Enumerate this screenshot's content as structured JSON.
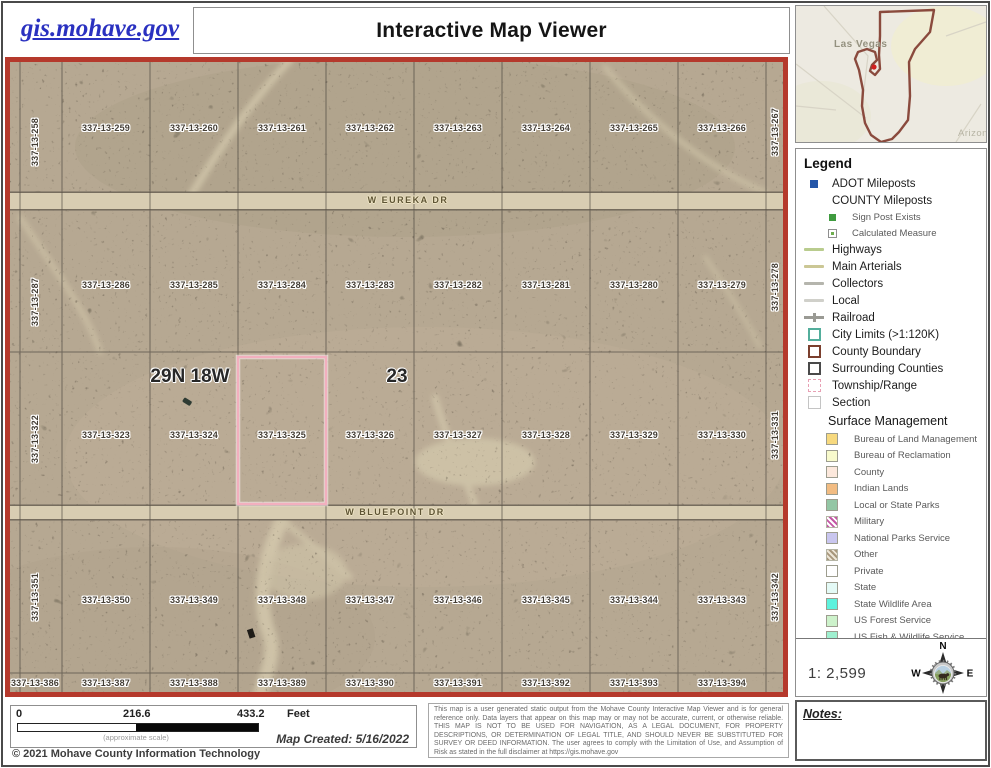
{
  "header": {
    "site_link": "gis.mohave.gov",
    "title": "Interactive Map Viewer"
  },
  "overview_map": {
    "city_label": "Las Vegas",
    "state_label": "Arizona",
    "boundary_color": "#8a4a3d",
    "marker_color": "#d11f1f"
  },
  "map": {
    "township_label": "29N 18W",
    "section_label": "23",
    "selected_parcel": "337-13-325",
    "selected_outline_color": "#f2afbe",
    "boundary_color": "#b5392c",
    "roads": [
      {
        "name": "W EUREKA DR",
        "x": 403,
        "y": 143
      },
      {
        "name": "W BLUEPOINT DR",
        "x": 390,
        "y": 455
      }
    ],
    "parcels": [
      {
        "label": "337-13-258",
        "x": 30,
        "y": 85,
        "vertical": true
      },
      {
        "label": "337-13-259",
        "x": 101,
        "y": 71
      },
      {
        "label": "337-13-260",
        "x": 189,
        "y": 71
      },
      {
        "label": "337-13-261",
        "x": 277,
        "y": 71
      },
      {
        "label": "337-13-262",
        "x": 365,
        "y": 71
      },
      {
        "label": "337-13-263",
        "x": 453,
        "y": 71
      },
      {
        "label": "337-13-264",
        "x": 541,
        "y": 71
      },
      {
        "label": "337-13-265",
        "x": 629,
        "y": 71
      },
      {
        "label": "337-13-266",
        "x": 717,
        "y": 71
      },
      {
        "label": "337-13-267",
        "x": 770,
        "y": 75,
        "vertical": true
      },
      {
        "label": "337-13-287",
        "x": 30,
        "y": 245,
        "vertical": true
      },
      {
        "label": "337-13-286",
        "x": 101,
        "y": 228
      },
      {
        "label": "337-13-285",
        "x": 189,
        "y": 228
      },
      {
        "label": "337-13-284",
        "x": 277,
        "y": 228
      },
      {
        "label": "337-13-283",
        "x": 365,
        "y": 228
      },
      {
        "label": "337-13-282",
        "x": 453,
        "y": 228
      },
      {
        "label": "337-13-281",
        "x": 541,
        "y": 228
      },
      {
        "label": "337-13-280",
        "x": 629,
        "y": 228
      },
      {
        "label": "337-13-279",
        "x": 717,
        "y": 228
      },
      {
        "label": "337-13-278",
        "x": 770,
        "y": 230,
        "vertical": true
      },
      {
        "label": "337-13-322",
        "x": 30,
        "y": 382,
        "vertical": true
      },
      {
        "label": "337-13-323",
        "x": 101,
        "y": 378
      },
      {
        "label": "337-13-324",
        "x": 189,
        "y": 378
      },
      {
        "label": "337-13-325",
        "x": 277,
        "y": 378
      },
      {
        "label": "337-13-326",
        "x": 365,
        "y": 378
      },
      {
        "label": "337-13-327",
        "x": 453,
        "y": 378
      },
      {
        "label": "337-13-328",
        "x": 541,
        "y": 378
      },
      {
        "label": "337-13-329",
        "x": 629,
        "y": 378
      },
      {
        "label": "337-13-330",
        "x": 717,
        "y": 378
      },
      {
        "label": "337-13-331",
        "x": 770,
        "y": 378,
        "vertical": true
      },
      {
        "label": "337-13-351",
        "x": 30,
        "y": 540,
        "vertical": true
      },
      {
        "label": "337-13-350",
        "x": 101,
        "y": 543
      },
      {
        "label": "337-13-349",
        "x": 189,
        "y": 543
      },
      {
        "label": "337-13-348",
        "x": 277,
        "y": 543
      },
      {
        "label": "337-13-347",
        "x": 365,
        "y": 543
      },
      {
        "label": "337-13-346",
        "x": 453,
        "y": 543
      },
      {
        "label": "337-13-345",
        "x": 541,
        "y": 543
      },
      {
        "label": "337-13-344",
        "x": 629,
        "y": 543
      },
      {
        "label": "337-13-343",
        "x": 717,
        "y": 543
      },
      {
        "label": "337-13-342",
        "x": 770,
        "y": 540,
        "vertical": true
      },
      {
        "label": "337-13-386",
        "x": 30,
        "y": 626
      },
      {
        "label": "337-13-387",
        "x": 101,
        "y": 626
      },
      {
        "label": "337-13-388",
        "x": 189,
        "y": 626
      },
      {
        "label": "337-13-389",
        "x": 277,
        "y": 626
      },
      {
        "label": "337-13-390",
        "x": 365,
        "y": 626
      },
      {
        "label": "337-13-391",
        "x": 453,
        "y": 626
      },
      {
        "label": "337-13-392",
        "x": 541,
        "y": 626
      },
      {
        "label": "337-13-393",
        "x": 629,
        "y": 626
      },
      {
        "label": "337-13-394",
        "x": 717,
        "y": 626
      }
    ]
  },
  "legend": {
    "title": "Legend",
    "items": [
      {
        "label": "ADOT Mileposts",
        "swatch": "square-fill",
        "color": "#2456a8",
        "size": 8,
        "icon": "adot-milepost-icon"
      },
      {
        "label": "COUNTY Mileposts",
        "swatch": "none",
        "icon": "county-milepost-icon"
      },
      {
        "label": "Sign Post Exists",
        "swatch": "square-fill",
        "color": "#3f9b3f",
        "size": 7,
        "indent": true,
        "icon": "sign-post-icon"
      },
      {
        "label": "Calculated Measure",
        "swatch": "square-dot",
        "size": 9,
        "indent": true,
        "icon": "calculated-measure-icon"
      },
      {
        "label": "Highways",
        "swatch": "line",
        "color": "#b9cc8e",
        "icon": "highway-line-icon"
      },
      {
        "label": "Main Arterials",
        "swatch": "line",
        "color": "#cbc795",
        "icon": "arterial-line-icon"
      },
      {
        "label": "Collectors",
        "swatch": "line",
        "color": "#b5b5ad",
        "icon": "collector-line-icon"
      },
      {
        "label": "Local",
        "swatch": "line",
        "color": "#d0d0ca",
        "icon": "local-line-icon"
      },
      {
        "label": "Railroad",
        "swatch": "line-cross",
        "color": "#9a9a94",
        "icon": "railroad-line-icon"
      },
      {
        "label": "City Limits (>1:120K)",
        "swatch": "square-outline",
        "color": "#53ae9c",
        "size": 13,
        "icon": "city-limits-icon"
      },
      {
        "label": "County Boundary",
        "swatch": "square-outline",
        "color": "#7b3f2e",
        "size": 13,
        "icon": "county-boundary-icon"
      },
      {
        "label": "Surrounding Counties",
        "swatch": "square-outline",
        "color": "#4a4a4a",
        "size": 13,
        "icon": "surrounding-counties-icon"
      },
      {
        "label": "Township/Range",
        "swatch": "square-outline-dashed",
        "color": "#e8a0b4",
        "size": 13,
        "icon": "township-range-icon"
      },
      {
        "label": "Section",
        "swatch": "square-outline",
        "color": "#c4c4c4",
        "size": 13,
        "bw": 1,
        "icon": "section-icon"
      }
    ],
    "surface_management": {
      "title": "Surface Management",
      "items": [
        {
          "label": "Bureau of Land Management",
          "swatch": "square-fill",
          "color": "#f7d97e",
          "size": 12,
          "bordered": true,
          "icon": "blm-swatch"
        },
        {
          "label": "Bureau of Reclamation",
          "swatch": "square-fill",
          "color": "#f8facc",
          "size": 12,
          "bordered": true,
          "icon": "reclamation-swatch"
        },
        {
          "label": "County",
          "swatch": "square-fill",
          "color": "#fce8dc",
          "size": 12,
          "bordered": true,
          "icon": "county-swatch"
        },
        {
          "label": "Indian Lands",
          "swatch": "square-fill",
          "color": "#f2bc82",
          "size": 12,
          "bordered": true,
          "icon": "indian-lands-swatch"
        },
        {
          "label": "Local or State Parks",
          "swatch": "square-fill",
          "color": "#93c6a4",
          "size": 12,
          "bordered": true,
          "icon": "parks-swatch"
        },
        {
          "label": "Military",
          "swatch": "hatch",
          "color": "#c357a5",
          "color2": "#ffffff",
          "size": 12,
          "icon": "military-swatch"
        },
        {
          "label": "National Parks Service",
          "swatch": "square-fill",
          "color": "#c9c6ef",
          "size": 12,
          "bordered": true,
          "icon": "nps-swatch"
        },
        {
          "label": "Other",
          "swatch": "hatch",
          "color": "#a8977c",
          "color2": "#ece5d6",
          "size": 12,
          "icon": "other-swatch"
        },
        {
          "label": "Private",
          "swatch": "square-fill",
          "color": "#ffffff",
          "size": 12,
          "bordered": true,
          "icon": "private-swatch"
        },
        {
          "label": "State",
          "swatch": "square-fill",
          "color": "#e4faf6",
          "size": 12,
          "bordered": true,
          "icon": "state-swatch"
        },
        {
          "label": "State Wildlife Area",
          "swatch": "square-fill",
          "color": "#5ef2dd",
          "size": 12,
          "bordered": true,
          "icon": "wildlife-area-swatch"
        },
        {
          "label": "US Forest Service",
          "swatch": "square-fill",
          "color": "#cdf2cb",
          "size": 12,
          "bordered": true,
          "icon": "forest-service-swatch"
        }
      ],
      "cutoff_item": {
        "label": "US Fish & Wildlife Service",
        "swatch": "square-fill",
        "color": "#9ff0d0",
        "size": 12,
        "bordered": true,
        "icon": "fish-wildlife-swatch"
      }
    },
    "scale_ratio": "1: 2,599",
    "compass": {
      "n": "N",
      "e": "E",
      "s": "S",
      "w": "W"
    }
  },
  "footer": {
    "scale_bar": {
      "ticks": [
        "0",
        "216.6",
        "433.2"
      ],
      "unit": "Feet",
      "note": "(approximate scale)"
    },
    "map_created": "Map Created: 5/16/2022",
    "copyright": "© 2021 Mohave County Information Technology",
    "disclaimer": "This map is a user generated static output from the Mohave County Interactive Map Viewer and is for general reference only. Data layers that appear on this map may or may not be accurate, current, or otherwise reliable. THIS MAP IS NOT TO BE USED FOR NAVIGATION, AS A LEGAL DOCUMENT, FOR PROPERTY DESCRIPTIONS, OR DETERMINATION OF LEGAL TITLE, AND SHOULD NEVER BE SUBSTITUTED FOR SURVEY OR DEED INFORMATION. The user agrees to comply with the Limitation of Use, and Assumption of Risk as stated in the full disclaimer at https://gis.mohave.gov"
  },
  "notes": {
    "label": "Notes:"
  }
}
